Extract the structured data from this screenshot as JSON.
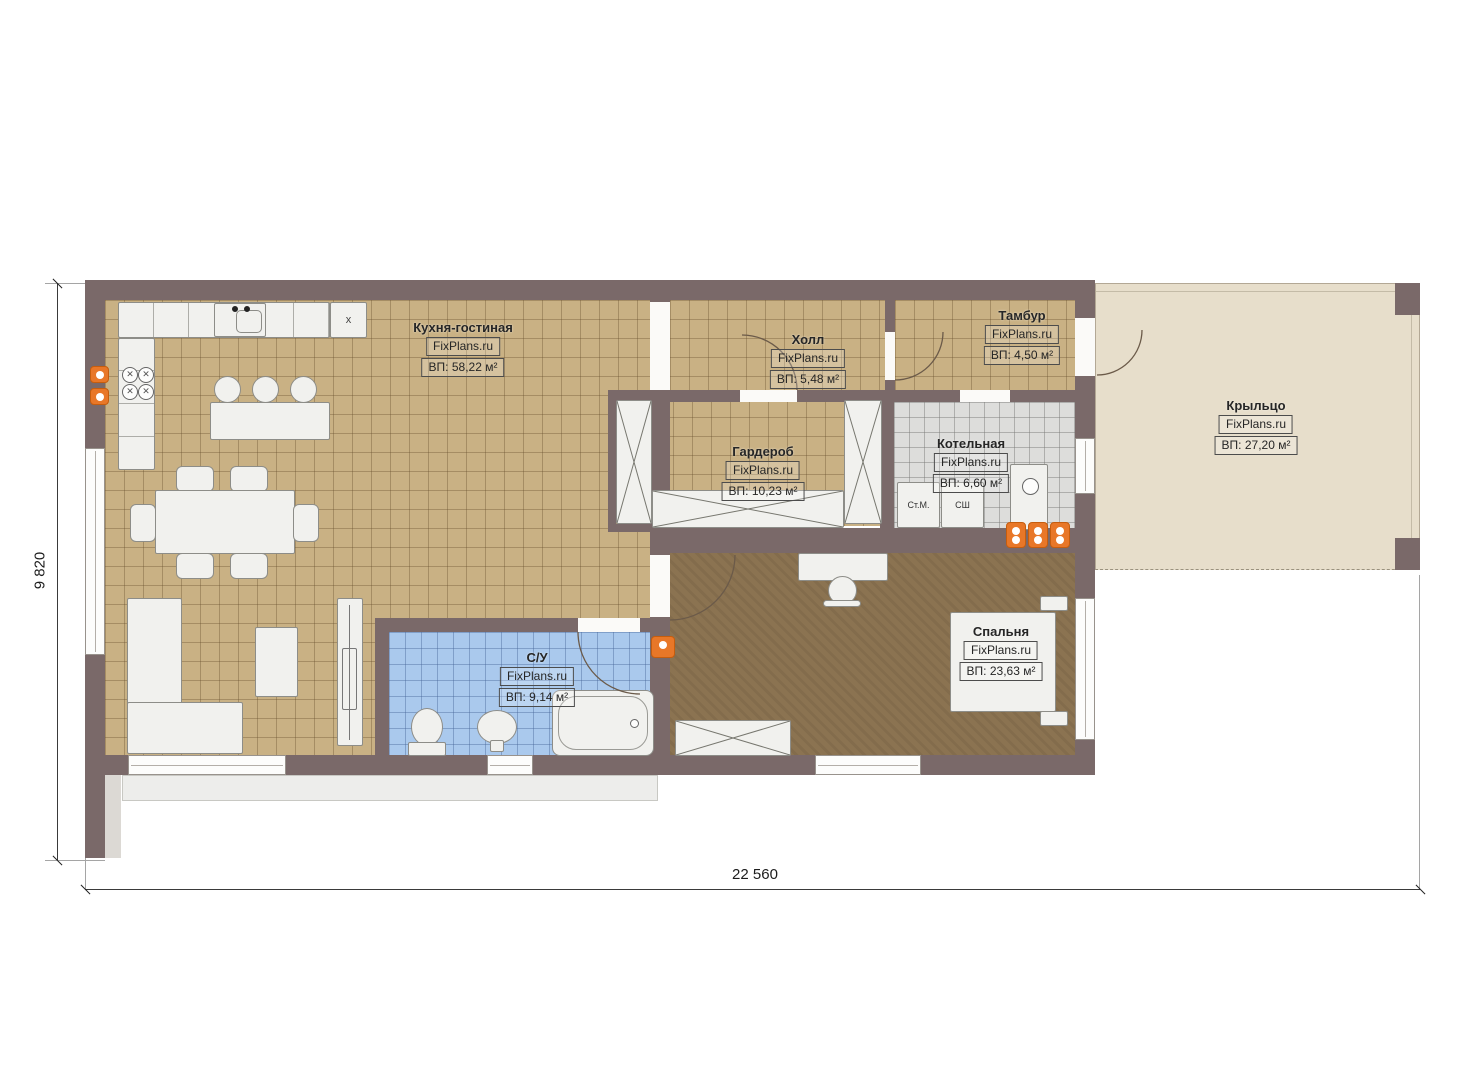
{
  "plan": {
    "dimensions": {
      "width_label": "22 560",
      "height_label": "9 820"
    },
    "rooms": {
      "kitchen_living": {
        "name": "Кухня-гостиная",
        "brand": "FixPlans.ru",
        "area": "ВП: 58,22 м²"
      },
      "hall": {
        "name": "Холл",
        "brand": "FixPlans.ru",
        "area": "ВП: 5,48 м²"
      },
      "vestibule": {
        "name": "Тамбур",
        "brand": "FixPlans.ru",
        "area": "ВП: 4,50 м²"
      },
      "wardrobe": {
        "name": "Гардероб",
        "brand": "FixPlans.ru",
        "area": "ВП: 10,23 м²"
      },
      "boiler": {
        "name": "Котельная",
        "brand": "FixPlans.ru",
        "area": "ВП: 6,60 м²"
      },
      "porch": {
        "name": "Крыльцо",
        "brand": "FixPlans.ru",
        "area": "ВП: 27,20 м²"
      },
      "bathroom": {
        "name": "С/У",
        "brand": "FixPlans.ru",
        "area": "ВП: 9,14 м²"
      },
      "bedroom": {
        "name": "Спальня",
        "brand": "FixPlans.ru",
        "area": "ВП: 23,63 м²"
      }
    },
    "appliances": {
      "washing_machine": "Ст.М.",
      "drying_cabinet": "СШ",
      "cabinet_mark": "x",
      "burner_mark": "✕"
    },
    "colors": {
      "wall": "#7a6969",
      "floor_tile_tan": "#c9b184",
      "floor_tile_gray": "#dddddb",
      "floor_tile_blue": "#aac9ed",
      "floor_wood": "#8b7351",
      "porch": "#e7decb",
      "accent_orange": "#e87728"
    }
  }
}
